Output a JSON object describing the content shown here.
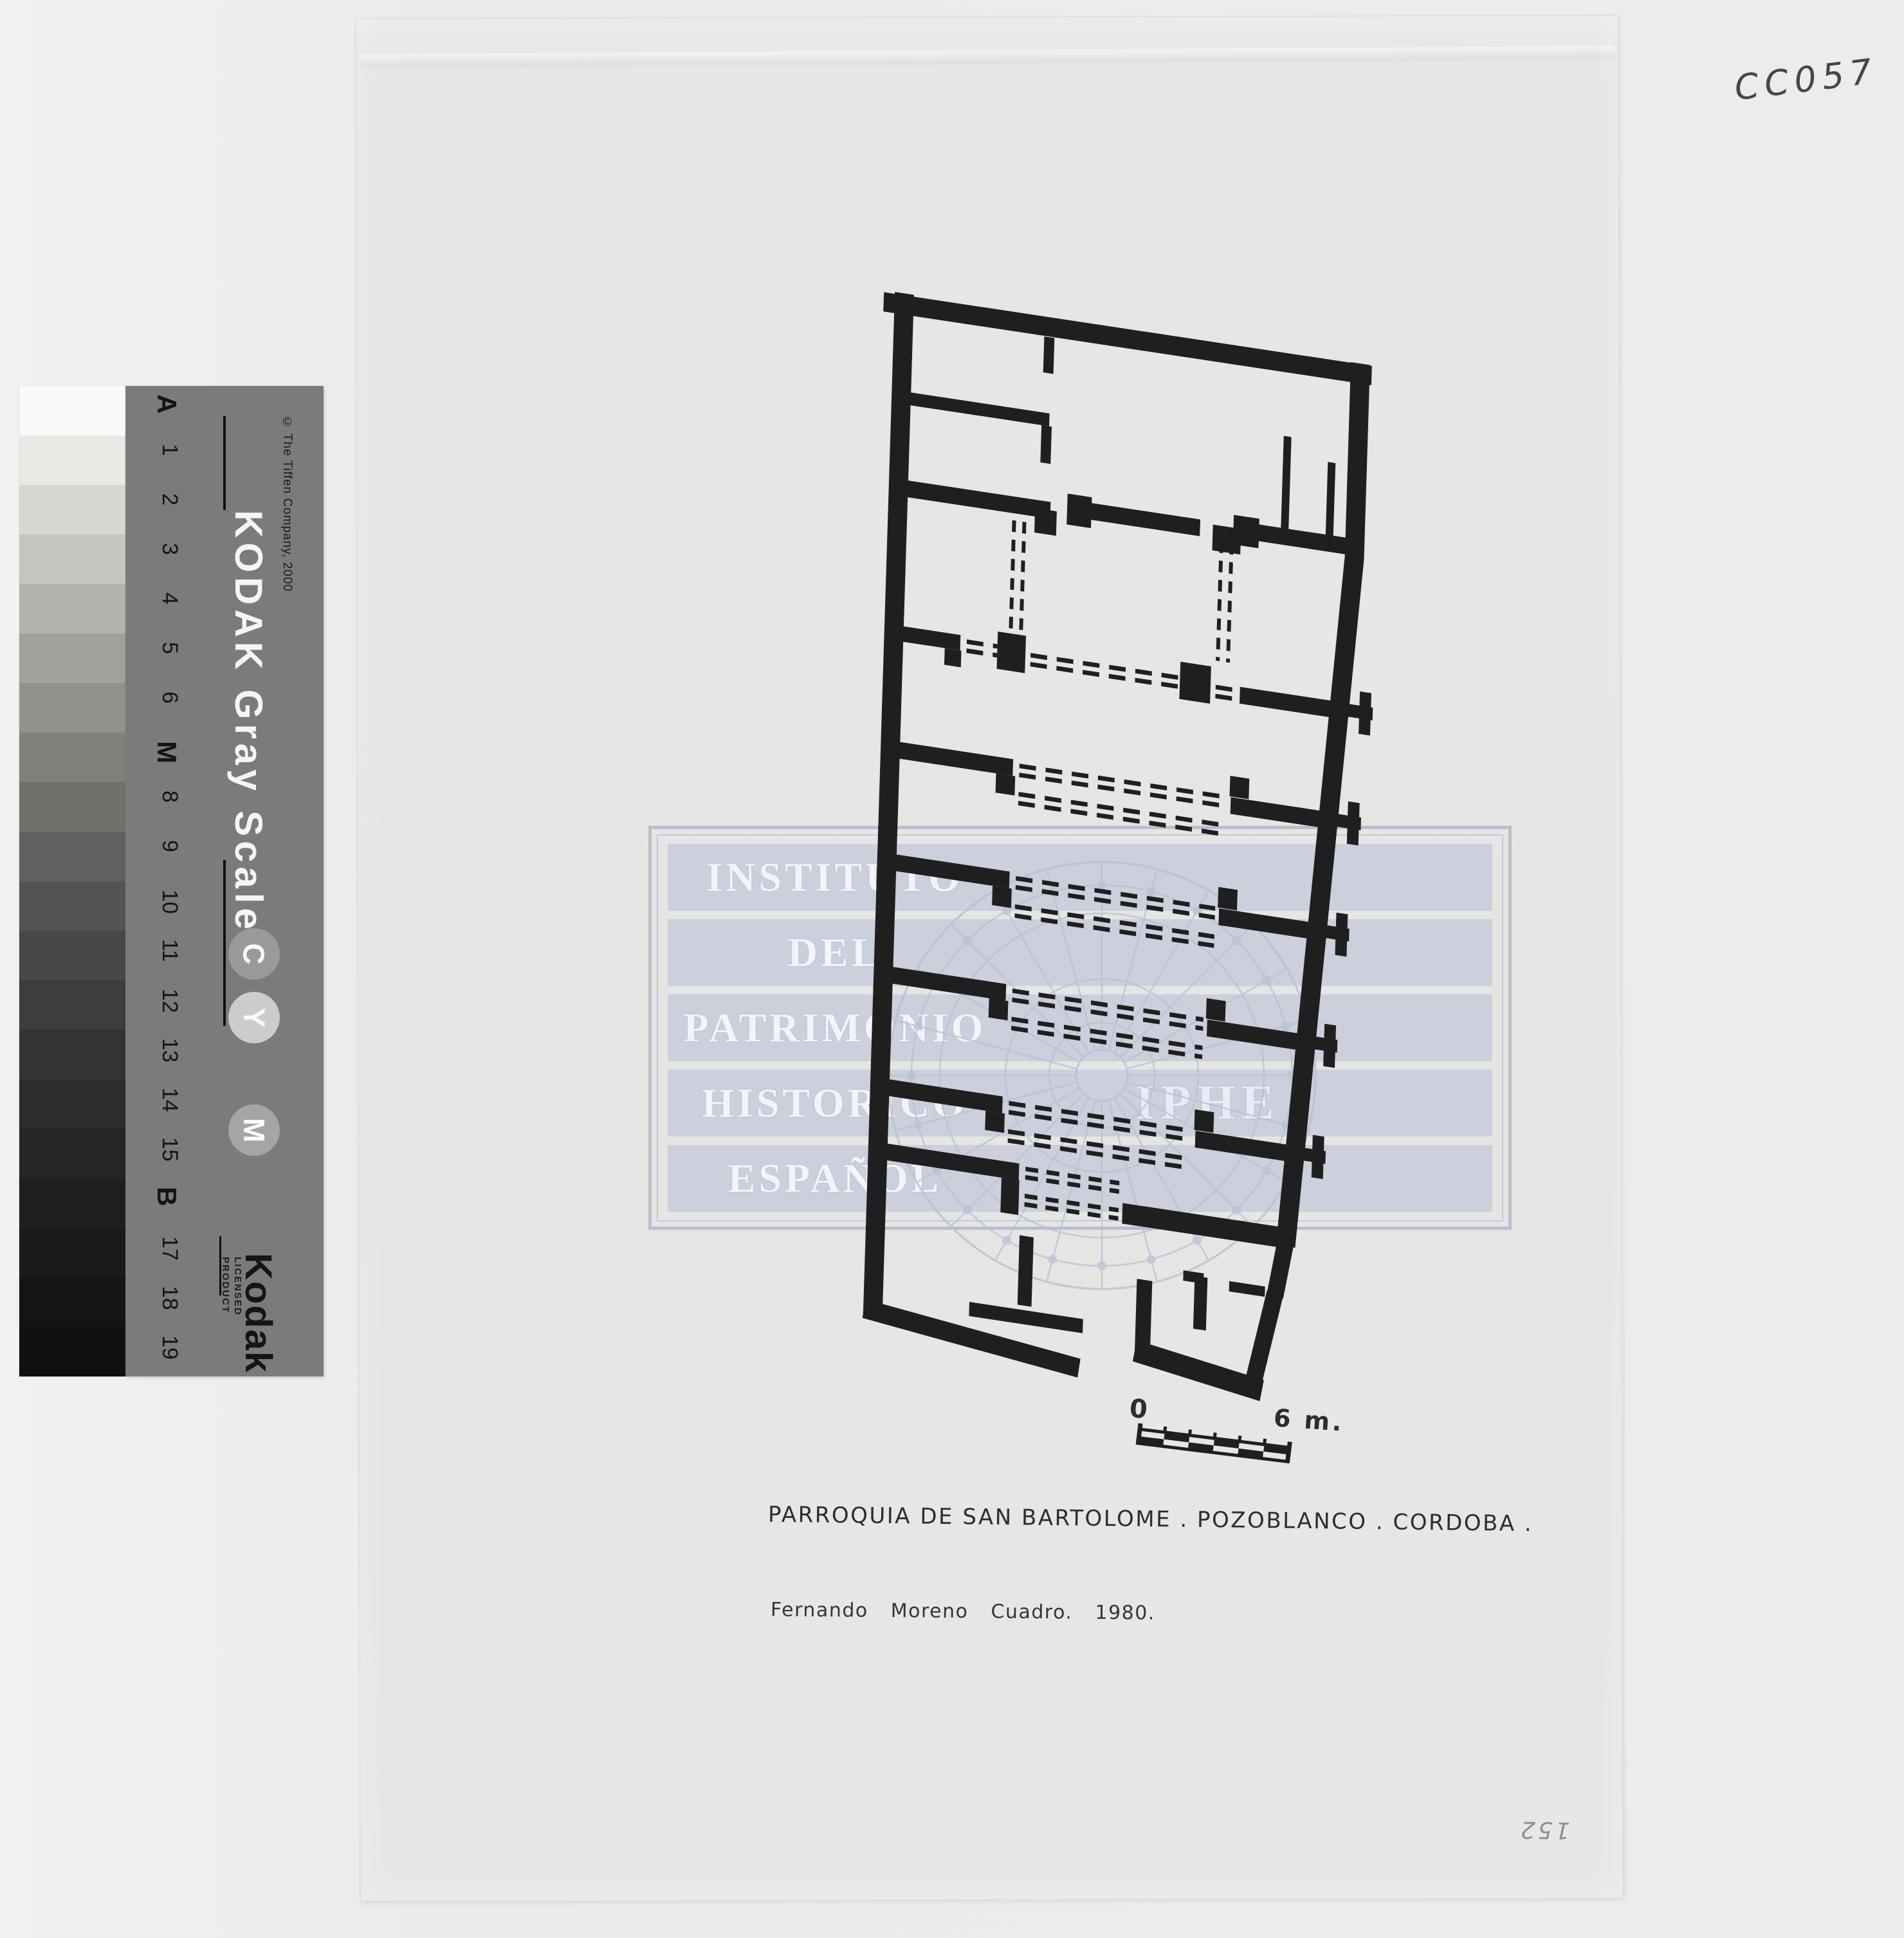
{
  "annotations": {
    "top_right_code": "CC057",
    "bottom_right_number": "152"
  },
  "title_block": {
    "line1": "PARROQUIA DE SAN BARTOLOME . POZOBLANCO . CORDOBA .",
    "line2": "Fernando Moreno Cuadro. 1980."
  },
  "scale_bar": {
    "start_label": "0",
    "end_label": "6 m."
  },
  "watermark": {
    "lines": [
      "INSTITUTO",
      "DEL",
      "PATRIMONIO",
      "HISTORICO",
      "ESPAÑOL"
    ],
    "acronym": "IPHE"
  },
  "grayscale": {
    "title": "KODAK Gray Scale",
    "copyright": "© The Tiffen Company, 2000",
    "brand": "Kodak",
    "brand_caption": "LICENSED PRODUCT",
    "labels": [
      "A",
      "1",
      "2",
      "3",
      "4",
      "5",
      "6",
      "M",
      "8",
      "9",
      "10",
      "11",
      "12",
      "13",
      "14",
      "15",
      "B",
      "17",
      "18",
      "19"
    ],
    "bold_labels": [
      "A",
      "M",
      "B"
    ],
    "shades": [
      "#fafaf8",
      "#e8e8e5",
      "#d6d6d3",
      "#c4c4c1",
      "#b2b2af",
      "#a1a19e",
      "#90908d",
      "#80807d",
      "#70706d",
      "#616160",
      "#545453",
      "#484847",
      "#3d3d3c",
      "#343433",
      "#2c2c2b",
      "#252524",
      "#1f1f1e",
      "#1a1a19",
      "#151514",
      "#101010"
    ],
    "circles": [
      {
        "letter": "C",
        "fill": "#9a9a9a"
      },
      {
        "letter": "Y",
        "fill": "#cccccb"
      },
      {
        "letter": "M",
        "fill": "#a5a5a3"
      }
    ]
  }
}
